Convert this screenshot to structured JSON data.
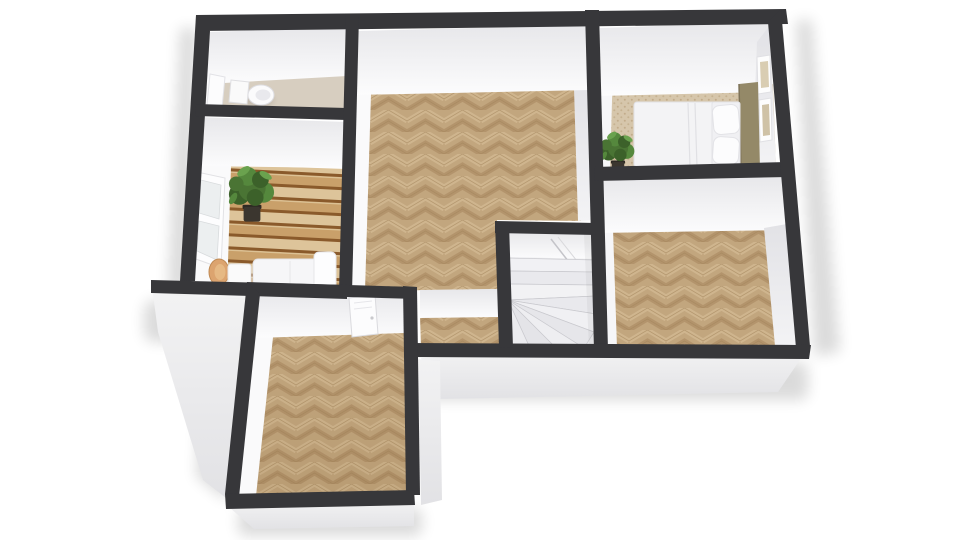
{
  "scene": {
    "title": "3D rendered floor plan, top-down perspective view",
    "background": "#ffffff"
  },
  "colors": {
    "wall": "#37373a",
    "faceTop": "#e7e7ea",
    "faceBottom": "#fcfcfd",
    "faceEastTop": "#e2e2e6",
    "faceEastBottom": "#f3f3f5",
    "faceWest": "#fafafb",
    "exteriorTop": "#f2f2f3",
    "exteriorBottom": "#e2e2e5",
    "herringboneBase": "#c2a67e",
    "herringboneLight": "#cfb58e",
    "herringboneDark": "#b3946c",
    "herringboneLine": "#a3855c",
    "deckPlank": "#c9a06a",
    "deckPlankAlt": "#ddc49a",
    "deckGap": "#8a5a2b",
    "deckHighlight": "#e9d6b0",
    "tile": "#d7cec0",
    "carpet": "#d6c6ab",
    "carpetDot": "#c2ac8b",
    "stair": "#ebebee",
    "stairBandLight": "#f1f1f4",
    "stairBandMid": "#e9e9ed",
    "stairBandDark": "#e4e4e8",
    "stairEdge": "#c9c9ce",
    "white": "#f6f6f8",
    "whiteBright": "#fdfdfe",
    "furnitureStroke": "#e2e2e6",
    "duvet": "#f3f3f5",
    "headboard": "#948968",
    "headboardEdge": "#7d7258",
    "chairWood": "#dca46f",
    "chairWoodLight": "#e6b984",
    "pot": "#3b362f",
    "potRim": "#2e2a24",
    "leafDark": "#3c612a",
    "leaf": "#4a7434",
    "leafLight": "#55883d",
    "leafPale": "#6aa24e",
    "frameArt": "#d9cdb2",
    "frameArt2": "#cfc2a6",
    "toiletInner": "#e9e9ed",
    "shadow": "#000000"
  },
  "rooms": [
    {
      "id": "wc",
      "label": "toilet room",
      "floor": "beige tile",
      "furniture": [
        "toilet"
      ]
    },
    {
      "id": "balcony",
      "label": "balcony terrace",
      "floor": "wood decking",
      "furniture": [
        "potted plant",
        "lounge sofa",
        "side table",
        "round chair"
      ]
    },
    {
      "id": "living",
      "label": "living room",
      "floor": "herringbone parquet",
      "furniture": []
    },
    {
      "id": "bedroom",
      "label": "bedroom",
      "floor": "dotted carpet",
      "furniture": [
        "double bed",
        "pillows",
        "headboard",
        "potted plant",
        "wall frames"
      ]
    },
    {
      "id": "room-east",
      "label": "east room",
      "floor": "herringbone parquet",
      "furniture": []
    },
    {
      "id": "stairwell",
      "label": "staircase",
      "floor": "winder stairs",
      "furniture": []
    },
    {
      "id": "hallway",
      "label": "hall",
      "floor": "herringbone parquet",
      "furniture": []
    },
    {
      "id": "room-south",
      "label": "south room",
      "floor": "herringbone parquet",
      "furniture": [
        "door"
      ]
    }
  ]
}
